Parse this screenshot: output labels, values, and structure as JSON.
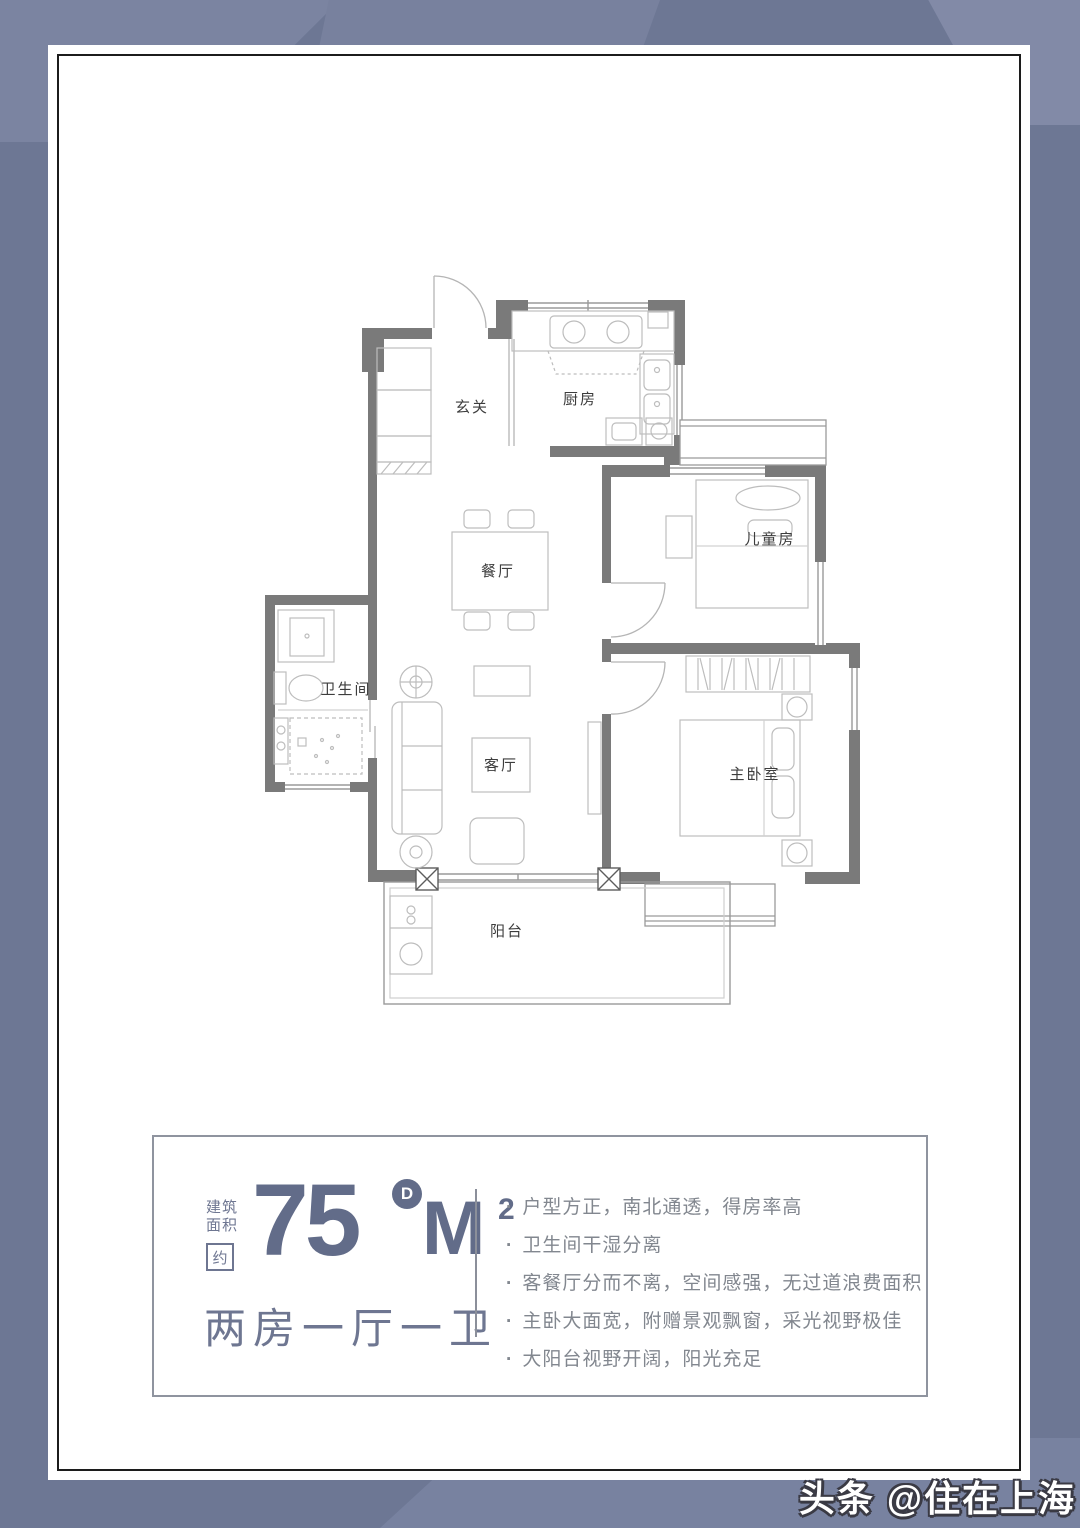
{
  "watermark": "头条 @住在上海",
  "floorplan": {
    "rooms": [
      {
        "id": "foyer",
        "label": "玄关"
      },
      {
        "id": "kitchen",
        "label": "厨房"
      },
      {
        "id": "dining",
        "label": "餐厅"
      },
      {
        "id": "bathroom",
        "label": "卫生间"
      },
      {
        "id": "living",
        "label": "客厅"
      },
      {
        "id": "children",
        "label": "儿童房"
      },
      {
        "id": "master",
        "label": "主卧室"
      },
      {
        "id": "balcony",
        "label": "阳台"
      }
    ]
  },
  "info_panel": {
    "area_label_line1": "建筑",
    "area_label_line2": "面积",
    "approx_label": "约",
    "area_value": "75",
    "unit_badge": "D",
    "unit": "M",
    "unit_exponent": "2",
    "layout_summary": "两房一厅一卫",
    "features": [
      "户型方正，南北通透，得房率高",
      "卫生间干湿分离",
      "客餐厅分而不离，空间感强，无过道浪费面积",
      "主卧大面宽，附赠景观飘窗，采光视野极佳",
      "大阳台视野开阔，阳光充足"
    ]
  },
  "colors": {
    "background": "#6d7794",
    "wall": "#7a7a7a",
    "accent": "#626c89",
    "feature_text": "#82878f"
  }
}
